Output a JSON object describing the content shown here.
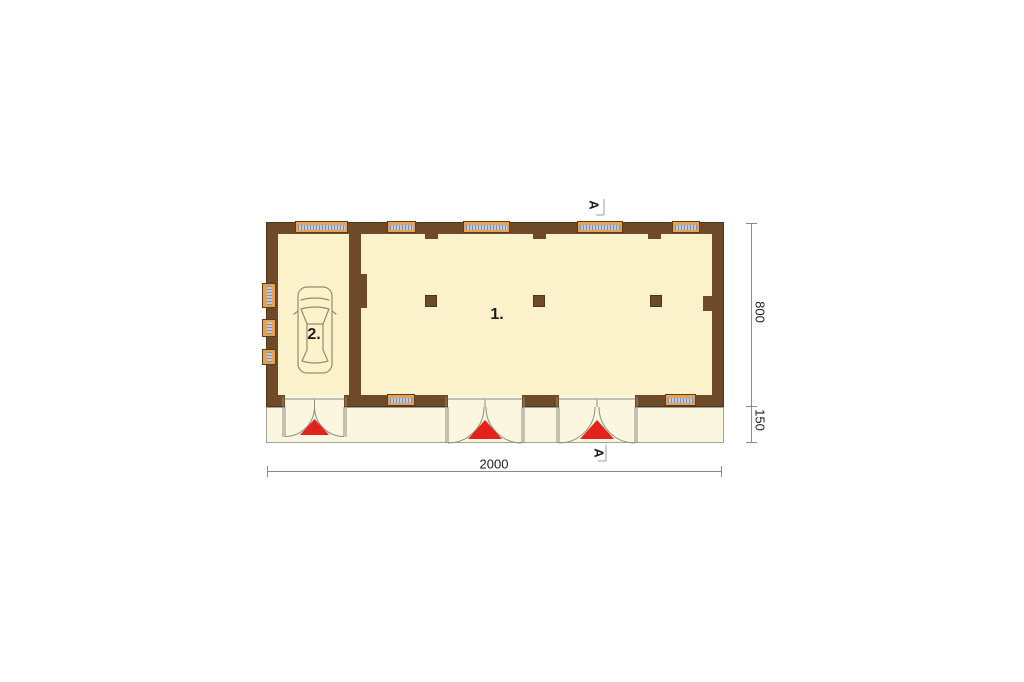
{
  "plan": {
    "rooms": [
      {
        "label": "1."
      },
      {
        "label": "2."
      }
    ],
    "dimensions": {
      "overall_width": "2000",
      "main_depth": "800",
      "porch_depth": "150"
    },
    "section_markers": [
      {
        "label": "A"
      },
      {
        "label": "A"
      }
    ],
    "colors": {
      "wall": "#6E4A28",
      "wall_outline": "#4F361B",
      "room_fill": "#FBF2CC",
      "porch_fill": "#FAF6DF",
      "porch_outline": "#A2A297",
      "window_frame": "#E6A254",
      "window_frame_outline": "#5A3C1E",
      "window_glass": "#BFCBDD",
      "window_glass_tick": "#7E90AF",
      "entrance_arrow": "#E2231D",
      "dim_line": "#8A8A8A",
      "door_line": "#8E8E7E",
      "car_line": "#9A8A68",
      "text": "#1C1C1C"
    }
  }
}
